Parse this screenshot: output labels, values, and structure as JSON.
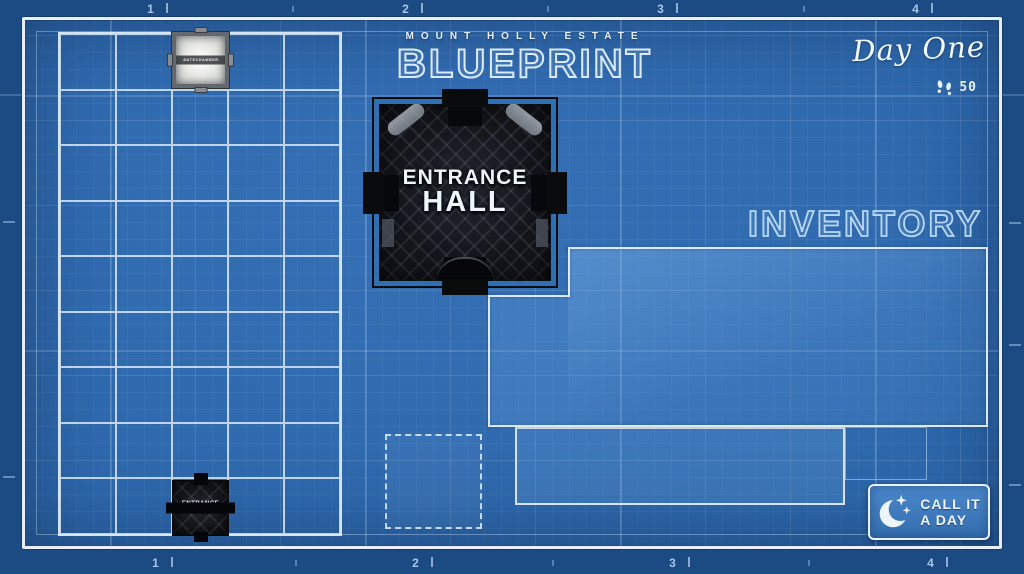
{
  "title_block": {
    "estate": "MOUNT HOLLY ESTATE",
    "title": "BLUEPRINT"
  },
  "status": {
    "day": "Day One",
    "steps": "50",
    "steps_icon": "footprints-icon"
  },
  "ruler": {
    "top": [
      "1",
      "2",
      "3",
      "4"
    ],
    "bottom": [
      "1",
      "2",
      "3",
      "4"
    ]
  },
  "grid": {
    "columns": 5,
    "rows": 9
  },
  "map_rooms": [
    {
      "name": "Antechamber",
      "label": "ANTECHAMBER",
      "row": 1,
      "col": 3,
      "style": "light"
    },
    {
      "name": "Entrance Hall",
      "line1": "ENTRANCE",
      "line2": "HALL",
      "row": 9,
      "col": 3,
      "style": "dark"
    }
  ],
  "room_card": {
    "line1": "ENTRANCE",
    "line2": "HALL"
  },
  "inventory": {
    "title": "INVENTORY"
  },
  "end_day_button": {
    "line1": "CALL IT",
    "line2": "A DAY",
    "icon": "moon-icon"
  },
  "colors": {
    "background": "#2d68ac",
    "margin": "#1c4b83",
    "frame": "#e8eff8",
    "panel_border": "#dfe9f4",
    "outline_text": "#dcebfb",
    "inventory_outline": "#b9d8f4",
    "text": "#eef5fd",
    "room_dark": "#14161b"
  }
}
